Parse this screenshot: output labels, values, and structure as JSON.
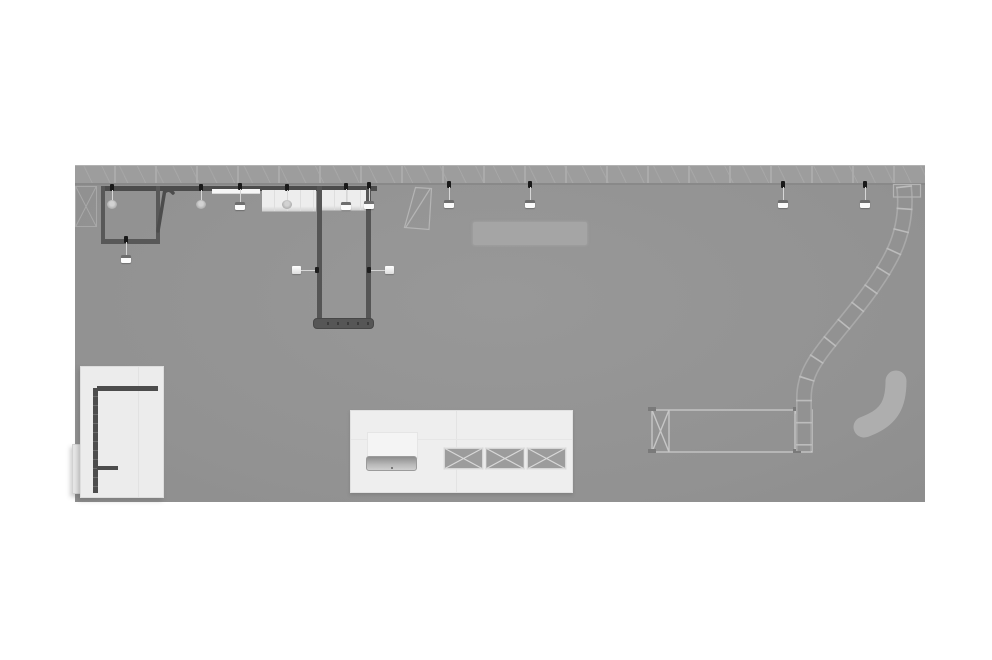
{
  "scene": {
    "type": "architectural floor plan render, top-down view",
    "background_color": "#ffffff",
    "visible_text": "none"
  },
  "palette": {
    "page_background": "#ffffff",
    "floor_gray": "#929292",
    "ceiling_truss": "#9d9d9d",
    "truss_line_light": "#ababab",
    "wall_dark": "#515151",
    "panel_light": "#ededed",
    "platform_white": "#eeeeee",
    "white_room": "#ececec",
    "rug_gray": "#a5a5a5",
    "bench_gray": "#aeaeae",
    "fixture_white": "#fbfbfb",
    "anchor_dot_black": "#191919"
  },
  "inventory": {
    "pendant_lights_white": 8,
    "pendant_lights_round": 3,
    "wall_sconces": 2,
    "crates_with_x_bracing": 3,
    "rooms_dark_walled": 2,
    "curved_truss_walls": 1,
    "straight_truss_walls": 1,
    "white_platforms": 2,
    "curved_bench": 1,
    "reception_desk": 1
  }
}
